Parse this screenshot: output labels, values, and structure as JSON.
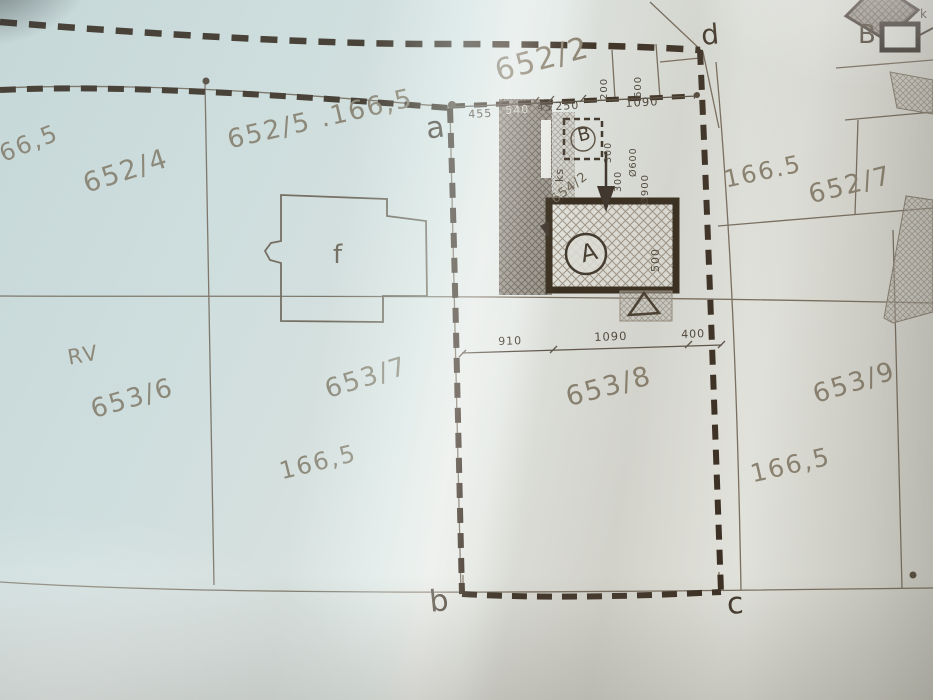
{
  "corner_points": {
    "a": "a",
    "b": "b",
    "c": "c",
    "d": "d"
  },
  "parcel_numbers": {
    "p652_2": "652/2",
    "p652_4": "652/4",
    "p652_5": "652/5 .166,5",
    "p652_7": "652/7",
    "p653_6": "653/6",
    "p653_7": "653/7",
    "p653_8": "653/8",
    "p653_9": "653/9",
    "p654_2": "654/2"
  },
  "elevations": {
    "top_left": "166,5",
    "right": "166.5",
    "mid_left": "166,5",
    "bottom_right": "166,5"
  },
  "buildings": {
    "f": "f",
    "a": "A",
    "b": "B"
  },
  "annotations": {
    "rv": "RV",
    "ks": "ks",
    "legend_b": "B",
    "legend_k": "k"
  },
  "dimensions": {
    "top_row": {
      "d455": "455",
      "d540": "540",
      "d45": "45",
      "d250": "250",
      "d1090": "1090"
    },
    "mid_row": {
      "d910": "910",
      "d1090": "1090",
      "d400": "400"
    },
    "vertical": {
      "d200": "200",
      "d600": "600",
      "d300a": "300",
      "d300b": "300",
      "d600o": "Ø600",
      "d900o": "Ø900",
      "d500": "500"
    }
  },
  "colors": {
    "paper": "#dde8e7",
    "ink": "#3b2f23",
    "pencil": "#8b8270",
    "survey_line": "#7a6f60"
  }
}
